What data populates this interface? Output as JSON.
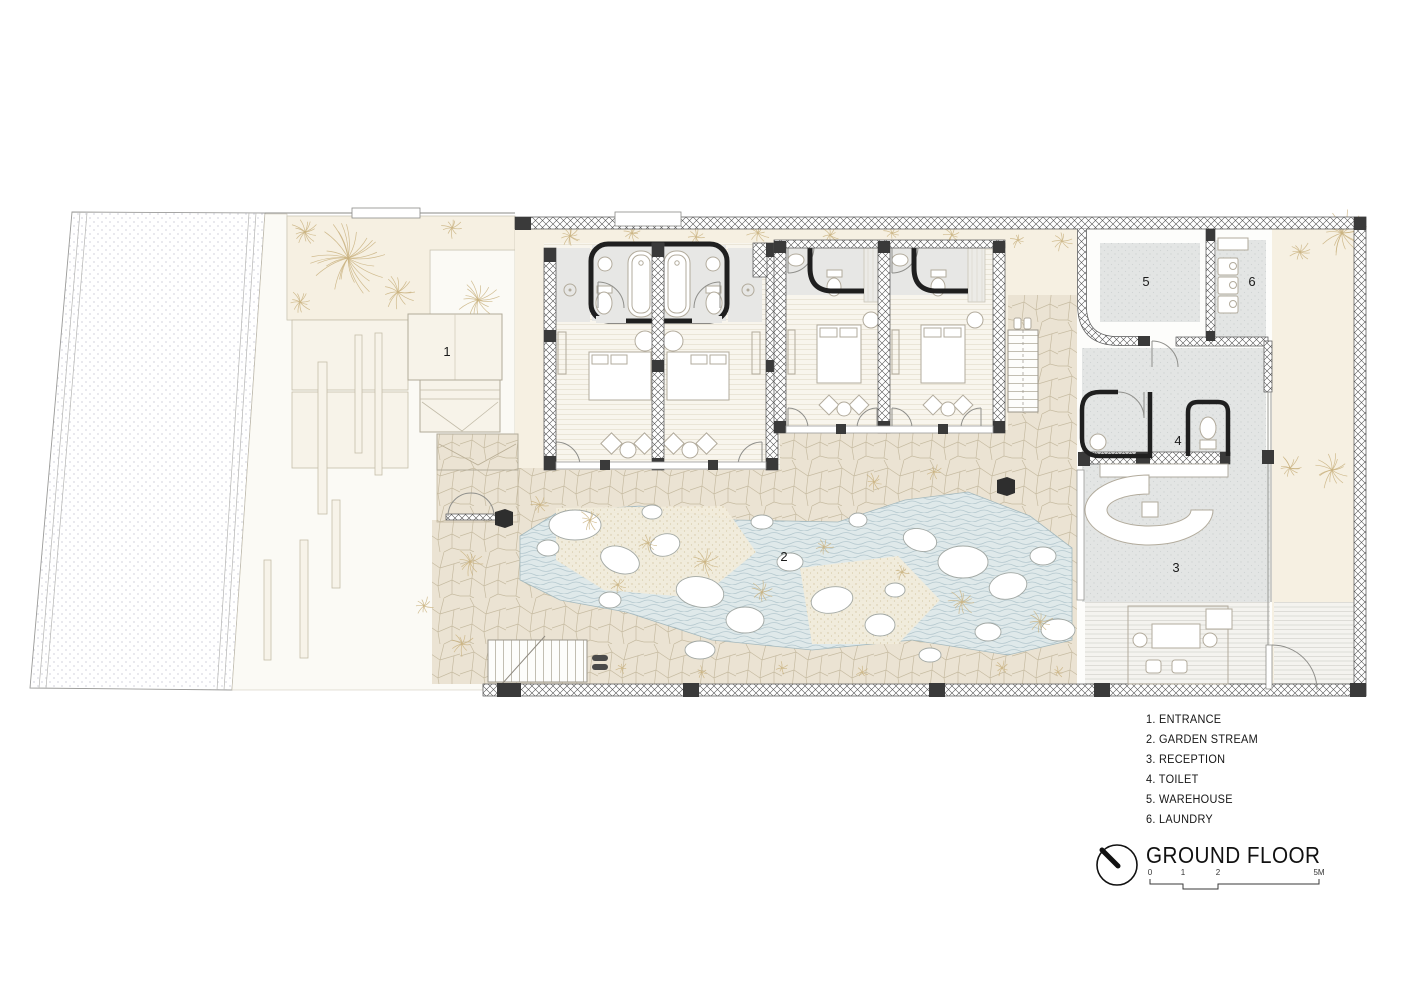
{
  "plan": {
    "room_labels": [
      "1",
      "2",
      "3",
      "4",
      "5",
      "6"
    ]
  },
  "legend": {
    "items": [
      "1. ENTRANCE",
      "2. GARDEN STREAM",
      "3. RECEPTION",
      "4. TOILET",
      "5. WAREHOUSE",
      "6. LAUNDRY"
    ]
  },
  "titleblock": {
    "title": "GROUND FLOOR",
    "scale_ticks": [
      "0",
      "1",
      "2",
      "5M"
    ]
  },
  "colors": {
    "paper": "#ffffff",
    "garden_cream": "#f6f0e2",
    "stone_paving": "#ebe3d3",
    "water": "#dfe9ea",
    "plant_stroke": "#c9b17f",
    "floor_gray": "#e4e6e5",
    "wall_dark": "#3a3a3a",
    "ink": "#161616"
  }
}
